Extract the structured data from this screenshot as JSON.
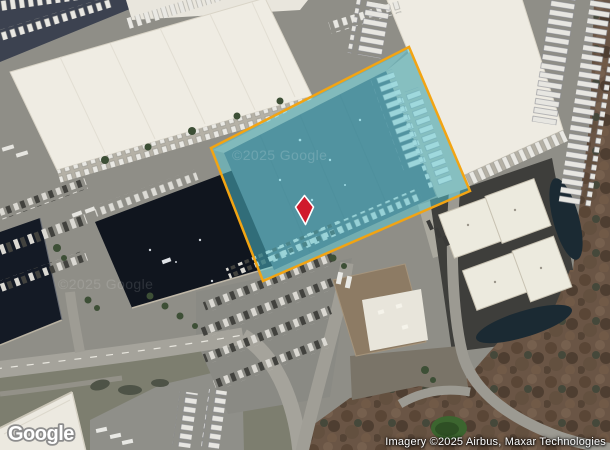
{
  "map": {
    "logo_text": "Google",
    "attribution_text": "Imagery ©2025 Airbus, Maxar Technologies",
    "watermark_text": "©2025 Google"
  },
  "parcel_overlay": {
    "fill_color": "#55cede",
    "border_color": "#f2a413"
  },
  "marker": {
    "fill_color": "#d01a2c",
    "outline_color": "#ffffff"
  }
}
